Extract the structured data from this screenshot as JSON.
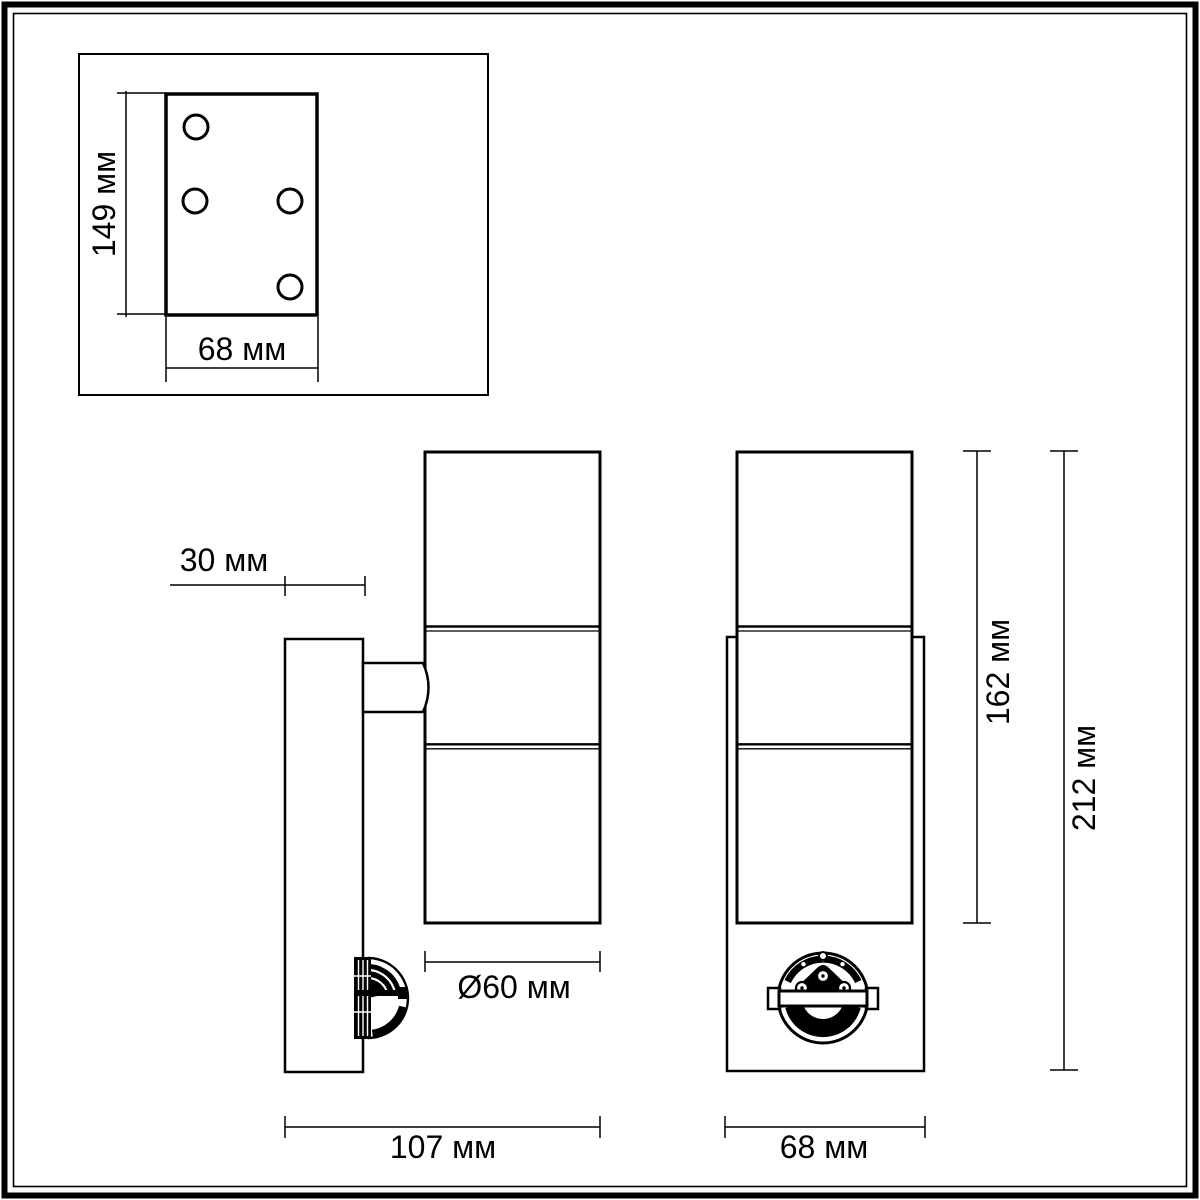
{
  "drawing": {
    "units": "мм",
    "colors": {
      "ink": "#000000",
      "background": "#ffffff"
    },
    "labels": {
      "plate_height": "149 мм",
      "plate_width": "68 мм",
      "wall_offset": "30 мм",
      "body_diameter": "Ø60 мм",
      "total_depth": "107 мм",
      "front_width": "68 мм",
      "lamp_height": "162 мм",
      "total_height": "212 мм"
    }
  }
}
